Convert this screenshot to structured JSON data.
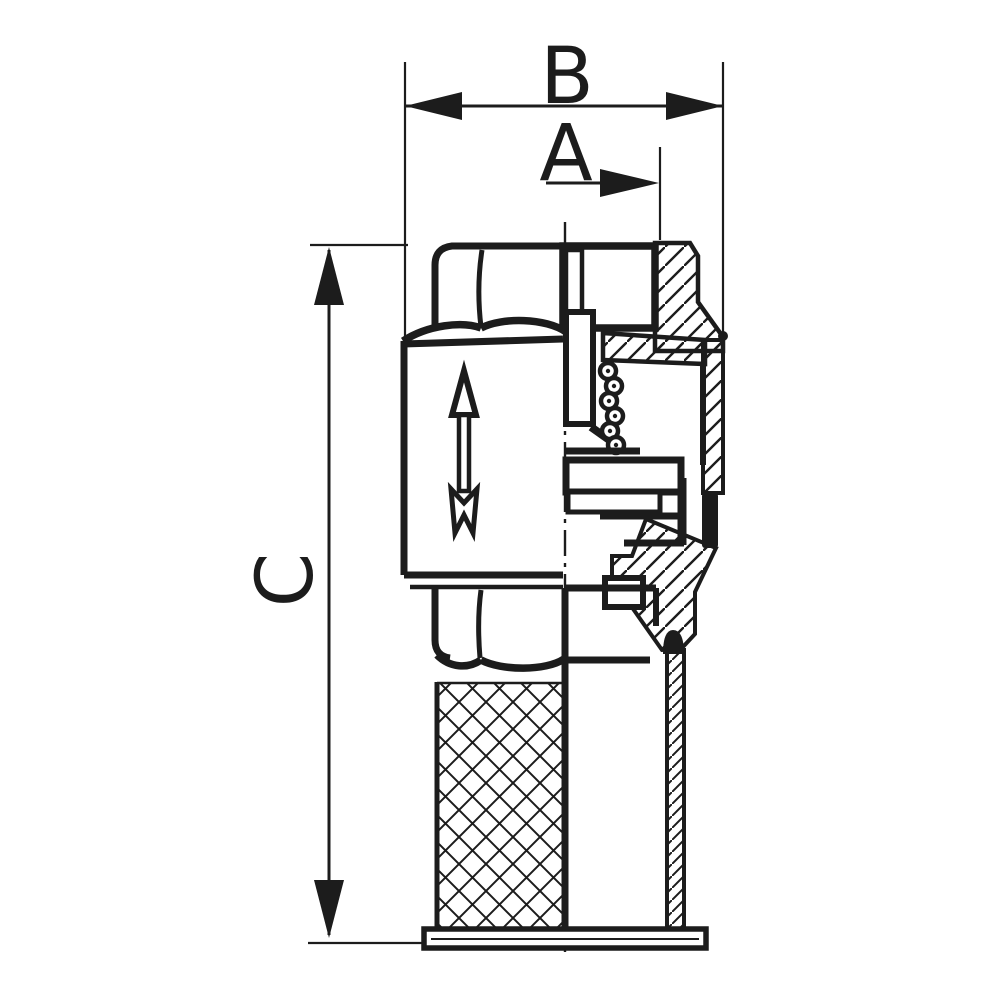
{
  "drawing": {
    "dimension_labels": {
      "b": "B",
      "a": "A",
      "c": "C"
    },
    "colors": {
      "ink": "#1c1c1c",
      "paper": "#ffffff"
    }
  }
}
